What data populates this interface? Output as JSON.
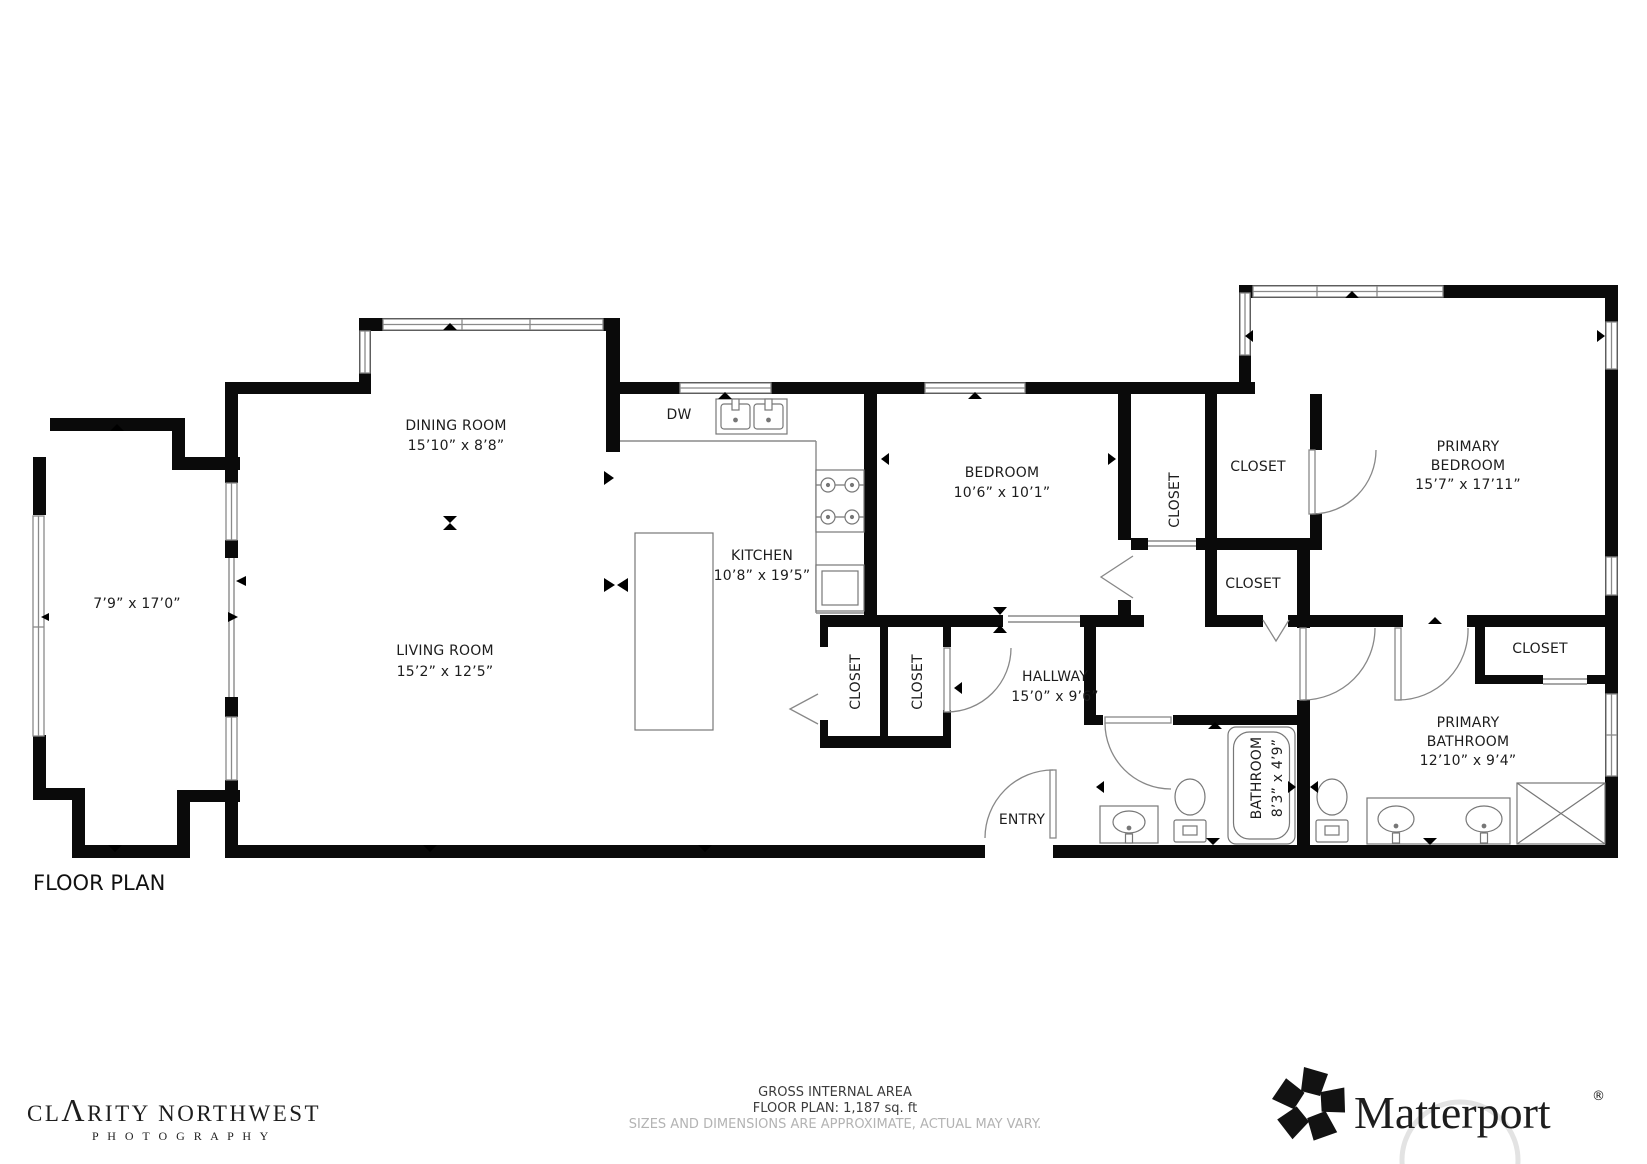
{
  "page": {
    "title": "FLOOR PLAN"
  },
  "plan": {
    "rooms": {
      "deck": {
        "dims": "7’9” x 17’0”"
      },
      "dining": {
        "name": "DINING ROOM",
        "dims": "15’10” x 8’8”"
      },
      "dw": {
        "name": "DW"
      },
      "kitchen": {
        "name": "KITCHEN",
        "dims": "10’8” x 19’5”"
      },
      "living": {
        "name": "LIVING ROOM",
        "dims": "15’2” x 12’5”"
      },
      "bedroom": {
        "name": "BEDROOM",
        "dims": "10’6” x 10’1”"
      },
      "primary_bedroom": {
        "name1": "PRIMARY",
        "name2": "BEDROOM",
        "dims": "15’7” x 17’11”"
      },
      "hallway": {
        "name": "HALLWAY",
        "dims": "15’0” x 9’6”"
      },
      "entry": {
        "name": "ENTRY"
      },
      "bathroom": {
        "name": "BATHROOM",
        "dims": "8’3” x 4’9”"
      },
      "primary_bathroom": {
        "name1": "PRIMARY",
        "name2": "BATHROOM",
        "dims": "12’10” x 9’4”"
      },
      "closet_label": "CLOSET"
    }
  },
  "footer": {
    "area_line1": "GROSS INTERNAL AREA",
    "area_line2": "FLOOR PLAN: 1,187 sq. ft",
    "area_line3": "SIZES AND DIMENSIONS ARE APPROXIMATE, ACTUAL MAY VARY.",
    "photographer": "CLARITY NORTHWEST",
    "photographer_parts": {
      "p1": "CL",
      "p2": "Λ",
      "p3": "RITY NORTHWEST"
    },
    "photographer_sub": "P H O T O G R A P H Y",
    "brand": "Matterport",
    "brand_mark": "®"
  }
}
